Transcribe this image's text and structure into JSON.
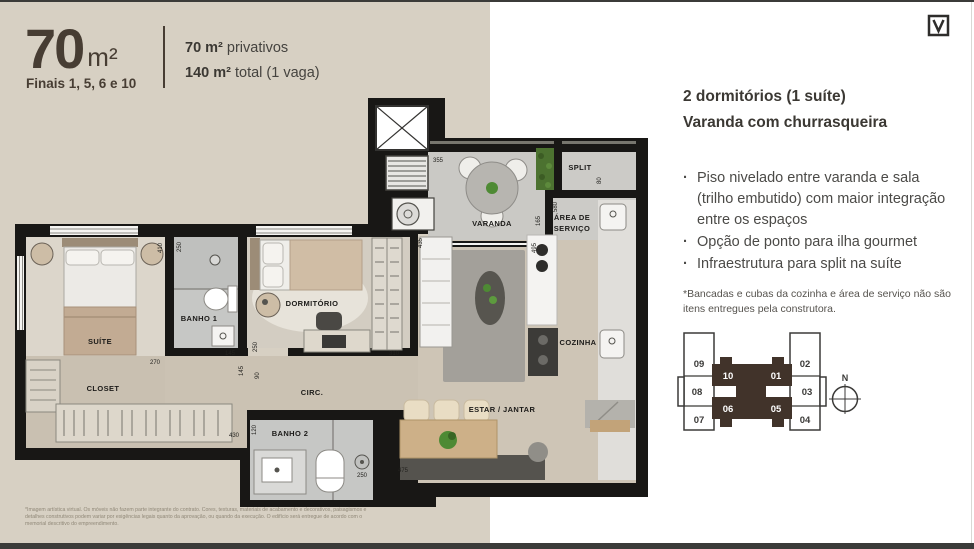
{
  "page": {
    "title_area": "70",
    "title_unit": "m²",
    "finais": "Finais 1, 5, 6 e 10",
    "privativos_bold": "70 m²",
    "privativos_rest": " privativos",
    "total_bold": "140 m²",
    "total_rest": " total (1 vaga)"
  },
  "details": {
    "title_line1": "2 dormitórios (1 suíte)",
    "title_line2": "Varanda com churrasqueira",
    "bullet_char": "·",
    "bullets": [
      "Piso nivelado entre varanda e sala (trilho embutido) com maior integração entre os espaços",
      "Opção de ponto para ilha gourmet",
      "Infraestrutura para split na suíte"
    ],
    "footnote": "*Bancadas e cubas da cozinha e área de serviço não são itens entregues pela construtora."
  },
  "floorplan": {
    "rooms": {
      "suite": "SUÍTE",
      "banho1": "BANHO 1",
      "closet": "CLOSET",
      "dormitorio": "DORMITÓRIO",
      "circ": "CIRC.",
      "banho2": "BANHO 2",
      "estar": "ESTAR / JANTAR",
      "cozinha": "COZINHA",
      "varanda": "VARANDA",
      "area_servico_1": "ÁREA DE",
      "area_servico_2": "SERVIÇO",
      "split": "SPLIT"
    },
    "dims": {
      "varanda_355": "355",
      "varanda_165": "165",
      "servico_580": "580",
      "split_80": "80",
      "banho1_250": "250",
      "suite_410": "410",
      "suite_270": "270",
      "banho1_145a": "145",
      "banho1_145b": "145",
      "dorm_250": "250",
      "dorm_310": "310",
      "circ_90": "90",
      "estar_435": "435",
      "cozinha_495": "495",
      "closet_430": "430",
      "banho2_120": "120",
      "banho2_250": "250",
      "jantar_475": "475"
    },
    "scale_note": "Situação sem escala.",
    "fine_print": "*Imagem artística virtual. Os móveis não fazem parte integrante do contrato. Cores, texturas, materiais de acabamento e decorativos, paisagismos e detalhes construtivos podem variar por exigências legais quanto da aprovação, ou quando da execução. O edifício será entregue de acordo com o memorial descritivo do empreendimento."
  },
  "keyplan": {
    "left_units": [
      "09",
      "08",
      "07"
    ],
    "right_units": [
      "02",
      "03",
      "04"
    ],
    "top_units": [
      "10",
      "01"
    ],
    "bottom_units": [
      "06",
      "05"
    ],
    "compass": "N"
  }
}
